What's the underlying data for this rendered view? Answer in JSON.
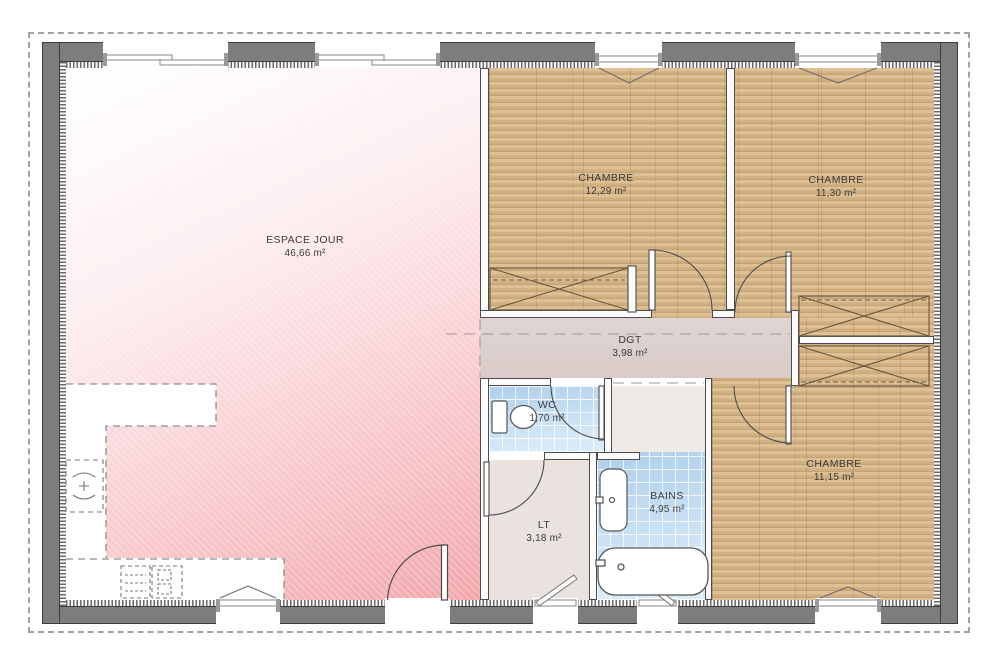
{
  "plan": {
    "rooms": [
      {
        "id": "espace-jour",
        "name": "ESPACE JOUR",
        "area": "46,66 m²"
      },
      {
        "id": "chambre-1",
        "name": "CHAMBRE",
        "area": "12,29 m²"
      },
      {
        "id": "chambre-2",
        "name": "CHAMBRE",
        "area": "11,30 m²"
      },
      {
        "id": "chambre-3",
        "name": "CHAMBRE",
        "area": "11,15 m²"
      },
      {
        "id": "degagement",
        "name": "DGT",
        "area": "3,98 m²"
      },
      {
        "id": "wc",
        "name": "WC",
        "area": "1,70 m²"
      },
      {
        "id": "salle-de-bains",
        "name": "BAINS",
        "area": "4,95 m²"
      },
      {
        "id": "lingerie",
        "name": "LT",
        "area": "3,18 m²"
      }
    ],
    "colors": {
      "wood_floor": "#d5b384",
      "pink_floor": "#f2a9ae",
      "tile_floor": "#bcd8f0",
      "hallway_floor": "#ddd2cf",
      "exterior_wall": "#7d7d7d"
    }
  }
}
